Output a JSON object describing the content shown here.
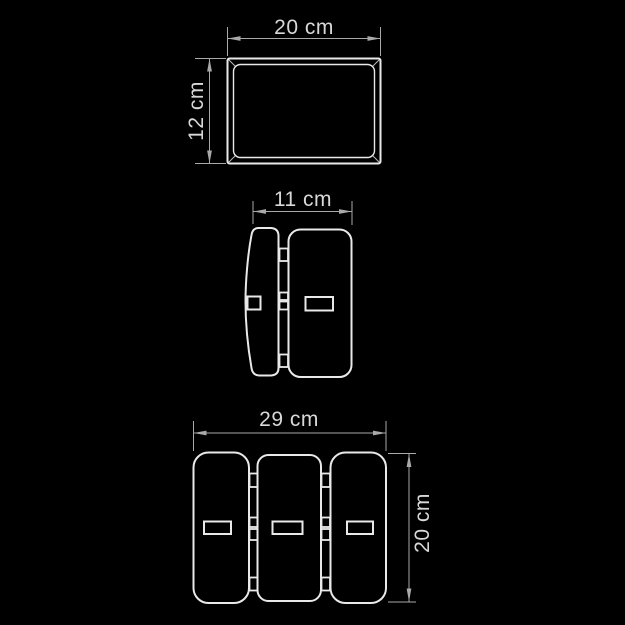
{
  "theme": {
    "background": "#000000",
    "line": "#e9e9e9",
    "dim": "#a9a9a9",
    "label": "#d8d8d8"
  },
  "views": {
    "top": {
      "width_label": "20 cm",
      "height_label": "12 cm"
    },
    "side": {
      "width_label": "11 cm"
    },
    "front": {
      "width_label": "29 cm",
      "height_label": "20 cm"
    }
  }
}
